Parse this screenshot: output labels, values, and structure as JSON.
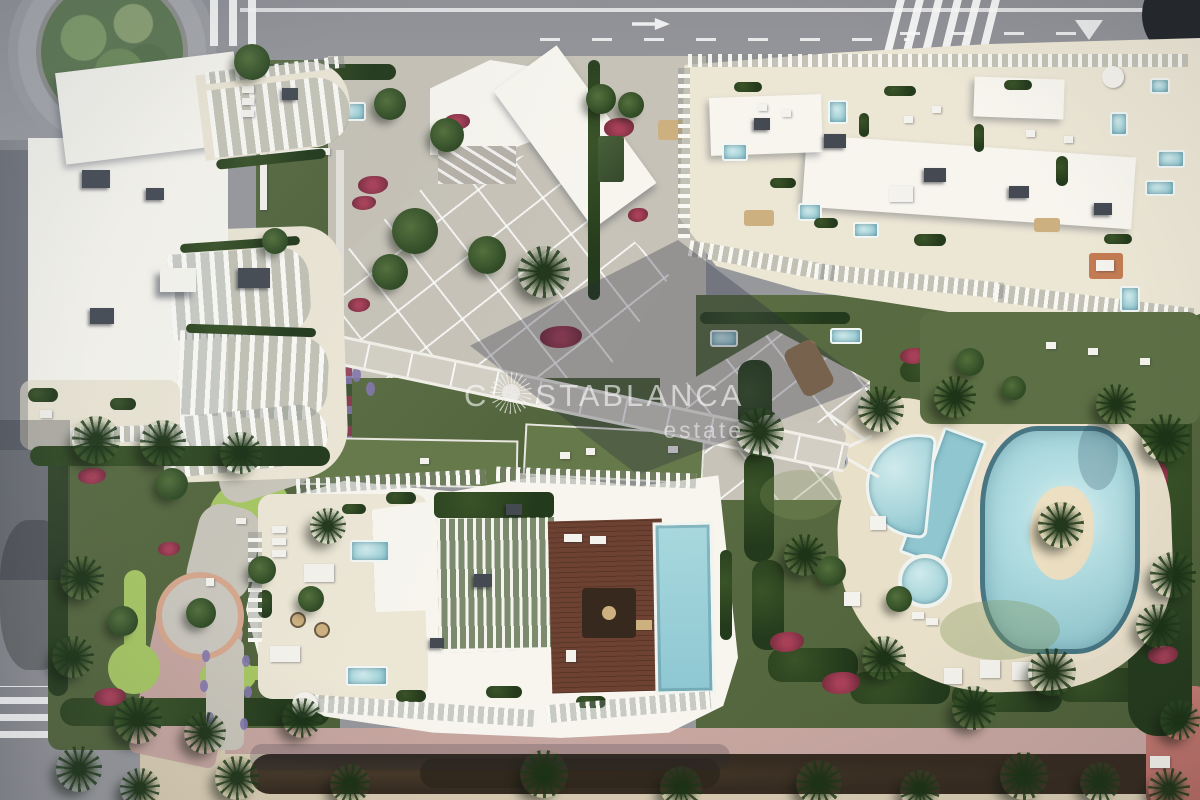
{
  "watermark": {
    "brand_prefix": "C",
    "brand_suffix": "STABLANCA",
    "tagline": "estate",
    "icon": "sun-rays-icon"
  },
  "colors": {
    "asphalt": "#97989c",
    "roof_white": "#f7f5ee",
    "terrace_cream": "#ece6d5",
    "lawn": "#4e6039",
    "putting": "#a7c763",
    "hedge": "#243a1c",
    "flower_red": "#7e2f42",
    "flower_purple": "#8377ae",
    "pool": "#a9d6db",
    "pool_deep": "#8fc6cf",
    "sand_deck": "#e9e0ca",
    "wood": "#6e4232",
    "walk_pink": "#c7a6a0",
    "sand_strip": "#d9cdb3",
    "dark_veg": "#362b20",
    "shadow": "rgba(36,41,58,0.30)",
    "watermark": "rgba(250,250,250,0.62)"
  }
}
